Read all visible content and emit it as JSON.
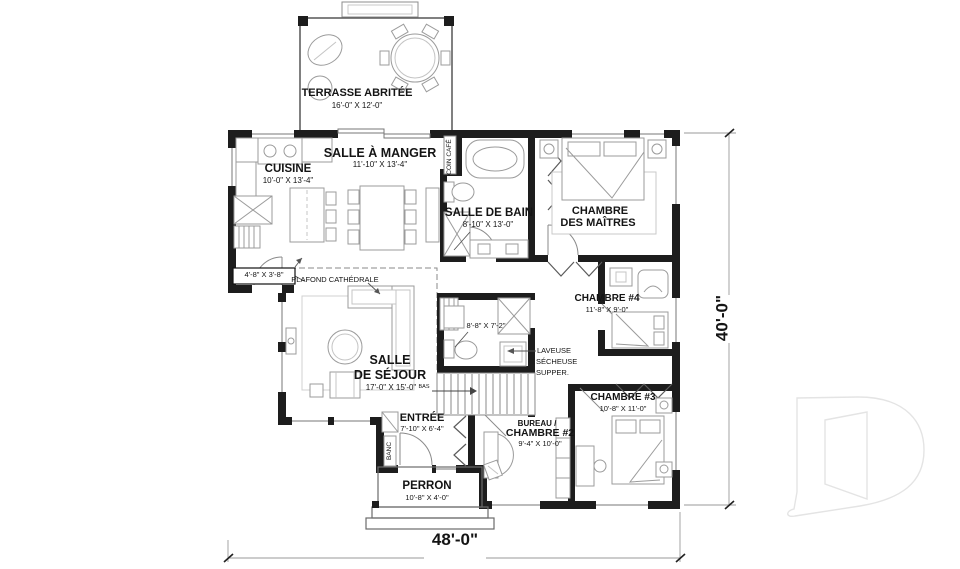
{
  "plan": {
    "overall_width": "48'-0\"",
    "overall_height": "40'-0\"",
    "rooms": {
      "terrasse": {
        "name": "TERRASSE ABRITÉE",
        "dim": "16'-0\" X 12'-0\""
      },
      "salle_a_manger": {
        "name": "SALLE À MANGER",
        "dim": "11'-10\" X 13'-4\""
      },
      "cuisine": {
        "name": "CUISINE",
        "dim": "10'-0\" X 13'-4\""
      },
      "salle_de_bain": {
        "name": "SALLE DE BAIN",
        "dim": "8'-10\" X 13'-0\""
      },
      "chambre_des_maitres": {
        "name": "CHAMBRE",
        "name2": "DES MAÎTRES"
      },
      "chambre_4": {
        "name": "CHAMBRE #4",
        "dim": "11'-8\" X 9'-0\""
      },
      "salle_de_sejour": {
        "name": "SALLE",
        "name2": "DE SÉJOUR",
        "dim": "17'-0\" X 15'-0\""
      },
      "chambre_3": {
        "name": "CHAMBRE #3",
        "dim": "10'-8\" X 11'-0\""
      },
      "bureau_chambre_2": {
        "name": "BUREAU /",
        "name2": "CHAMBRE #2",
        "dim": "9'-4\" X 10'-0\""
      },
      "entree": {
        "name": "ENTRÉE",
        "dim": "7'-10\" X 6'-4\""
      },
      "perron": {
        "name": "PERRON",
        "dim": "10'-8\" X 4'-0\""
      }
    },
    "annotations": {
      "plafond_cathedrale": "PLAFOND CATHÉDRALE",
      "coin_cafe": "COIN CAFÉ",
      "banc": "BANC",
      "bas": "BAS",
      "laveuse_line1": "LAVEUSE",
      "laveuse_line2": "SÉCHEUSE",
      "laveuse_line3": "SUPPER.",
      "dim_vestibule": "4'-8\" X 3'-8\"",
      "dim_salle_eau": "8'-8\" X 7'-2\""
    },
    "colors": {
      "wall": "#1d1d1d",
      "furniture": "#9b9b9b",
      "watermark": "#e4e4e4"
    }
  }
}
